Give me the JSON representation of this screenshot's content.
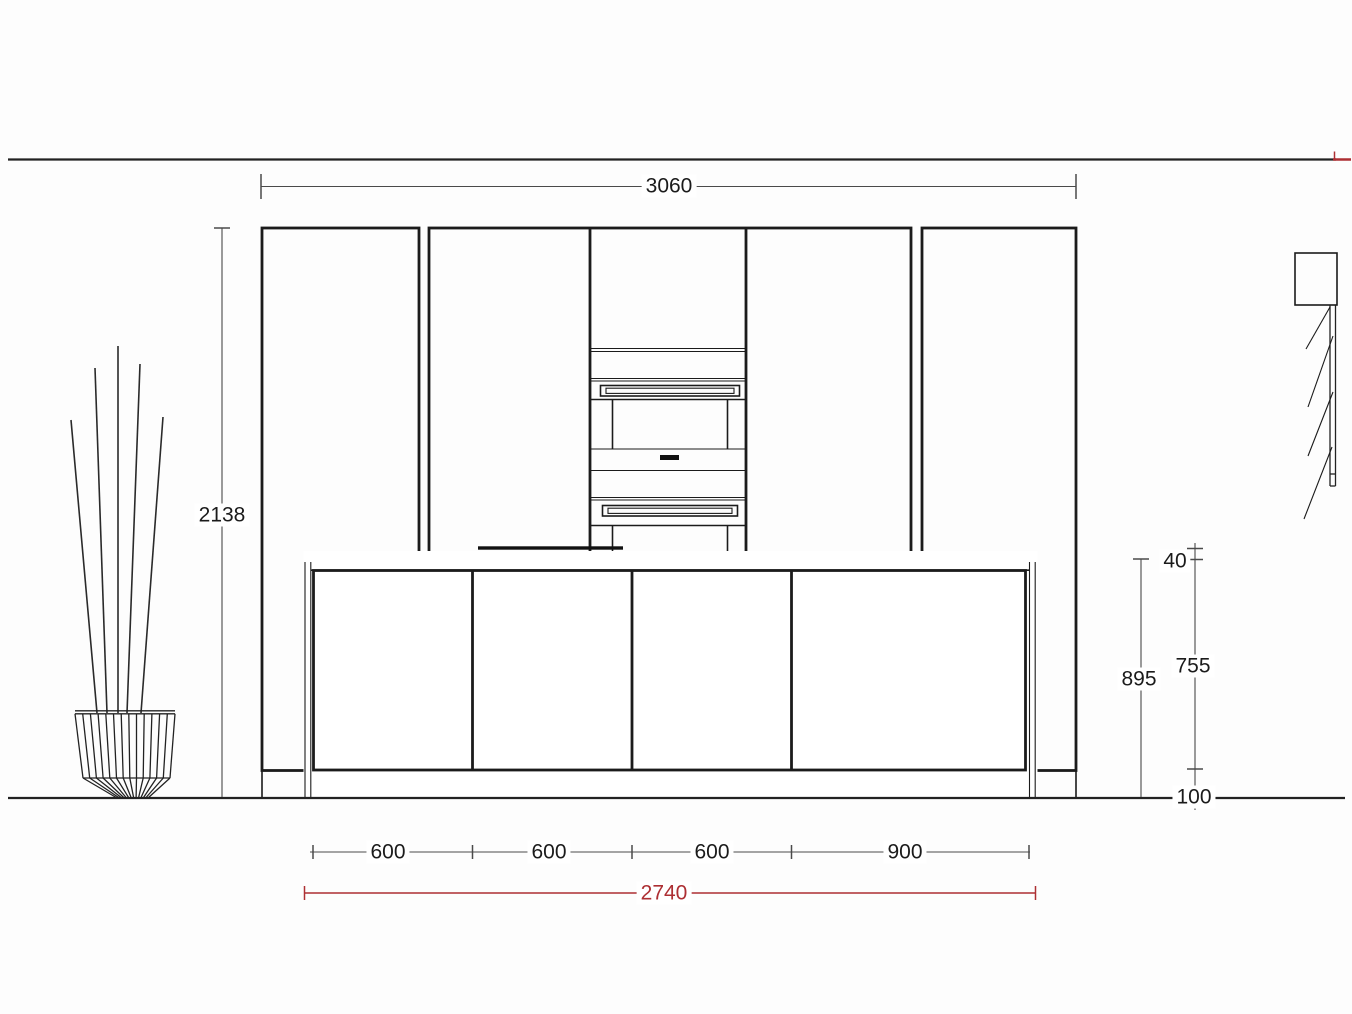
{
  "drawing": {
    "view": "kitchen-elevation",
    "colors": {
      "line": "#1b1b1b",
      "accent": "#ad2f33"
    },
    "dims": {
      "run_width": "3060",
      "total_height": "2138",
      "worktop_thickness": "40",
      "island_height": "895",
      "front_height": "755",
      "plinth_height": "100",
      "base_segments": [
        "600",
        "600",
        "600",
        "900"
      ],
      "base_total": "2740"
    }
  }
}
